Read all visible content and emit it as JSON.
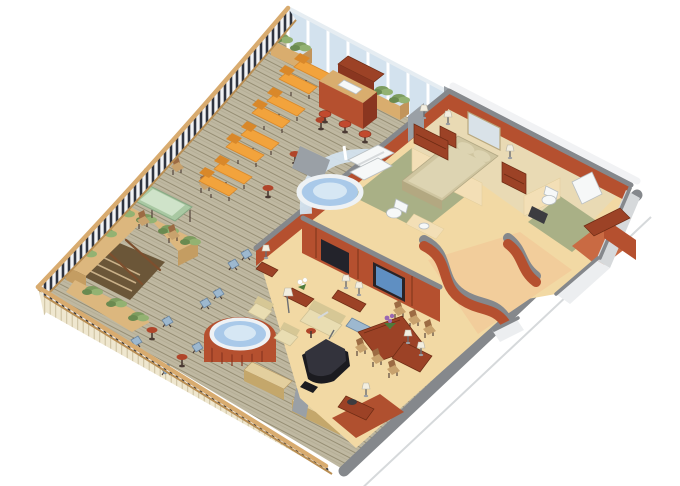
{
  "meta": {
    "scene": "Isometric cut-away floor plan illustration of a luxury ship penthouse suite with a large wrap-around teak veranda",
    "style": "3D isometric architectural rendering, white background, no text labels",
    "background": "#ffffff"
  },
  "areas": {
    "veranda_deck": {
      "label": "wrap-around teak deck",
      "features": [
        {
          "name": "curved-railing",
          "description": "wood top rail with dark balusters along the curved forward edge"
        },
        {
          "name": "glass-windbreak",
          "panels": 8
        },
        {
          "name": "sun-loungers",
          "count": 8,
          "arrangement": "4 pairs",
          "color": "orange"
        },
        {
          "name": "lounger-drink-tables",
          "count": 4,
          "color": "red"
        },
        {
          "name": "outdoor-bar",
          "stools": 4
        },
        {
          "name": "planter-boxes",
          "count": 2
        },
        {
          "name": "outdoor-dining-table",
          "top": "green glass",
          "chairs": 5
        },
        {
          "name": "pergola-stairwell",
          "description": "ivy-topped trellis enclosure around a private stair"
        },
        {
          "name": "bistro-sets",
          "tables": 2,
          "folding_chairs": 8
        },
        {
          "name": "deck-whirlpool",
          "shell": "terracotta",
          "water": "blue"
        },
        {
          "name": "deck-benches",
          "count": 2
        }
      ]
    },
    "suite_interior": {
      "master_bedroom": [
        "king-bed",
        "pillows",
        "mirror-panel",
        "nightstand-with-lamp x2",
        "dresser-with-lamp",
        "chest-with-lamp"
      ],
      "master_bathroom": [
        "shower-stall",
        "toilet",
        "vanity-with-sink",
        "green-tile-floor"
      ],
      "whirlpool_alcove": [
        "glass-bay",
        "whirlpool-tub",
        "stone-wall"
      ],
      "guest_bathroom": [
        "toilet",
        "dark-counter-sink",
        "shower",
        "green-tile-floor"
      ],
      "walk_in_closet": [
        "shelf-counter"
      ],
      "entry_foyer": [
        "curved-terracotta-walls",
        "entry-door"
      ],
      "living_room": [
        "media-cabinet-with-tv",
        "wall-tv-blue-screen",
        "sofa",
        "console-with-lamps x2",
        "armchairs x2",
        "coffee-table-with-white-flowers",
        "side-table-with-lamp",
        "floor-lamp",
        "round-side-table",
        "blue-bench"
      ],
      "dining_area": [
        "dark-wood-dining-table",
        "dining-chairs x6",
        "purple-orchid-centerpiece",
        "sideboard-with-lamps",
        "corner-sideboard-with-bowl"
      ],
      "music_corner": [
        "black-grand-piano",
        "piano-bench"
      ]
    }
  },
  "colors": {
    "bg": "#ffffff",
    "deck": "#bfb8a1",
    "deckLine": "#968e74",
    "deckLine2": "#a8a088",
    "fascia": "#efe7cf",
    "fasciaLine": "#cbbf9e",
    "fasciaTrim": "#b98e53",
    "cutGray": "#85888c",
    "extWhite": "#f1f2f4",
    "extShade": "#d6d9db",
    "white": "#ffffff",
    "railWood": "#d8ab6f",
    "railWoodDark": "#b98e53",
    "baluster": "#2f3440",
    "balusterBg": "#f2f3f5",
    "glass": "#d3e2ee",
    "glassFrame": "#ffffff",
    "planterBox": "#d9ad6e",
    "planterBoxSide": "#c2945a",
    "ivy1": "#7d9c5f",
    "ivy2": "#93b272",
    "ivy3": "#6a8a50",
    "lounger": "#f2a33c",
    "loungerDark": "#d9882a",
    "tableRed": "#b0452a",
    "stoolRed": "#c14a2e",
    "stoolDark": "#4a3a33",
    "chairWood": "#9c6b43",
    "chairWoodLight": "#c8a26d",
    "tableGreen": "#a9c8a2",
    "tableGreenLight": "#cfe3c9",
    "pergolaWall": "#dcb77e",
    "pergolaWallShade": "#c49d62",
    "pergolaInner": "#6b5638",
    "stairBrown": "#7d4f2e",
    "stepTan": "#c9b089",
    "tubWater": "#a9c9e9",
    "tubWaterLight": "#d6e7f4",
    "tubRim": "#eef2f5",
    "tubShell": "#b5502f",
    "tubShellDark": "#8a3620",
    "carpetLiving": "#f2d9a4",
    "carpetBed": "#e9dab4",
    "carpetEntry": "#f2cd9b",
    "bathFloor": "#a9b086",
    "floorRed": "#b0502f",
    "wallTerra": "#b5502f",
    "wallTerraLight": "#c96a43",
    "wallCream": "#f3dfb6",
    "wallWhite": "#eceef0",
    "furnRed": "#9c4226",
    "furnRedDark": "#6e2c14",
    "cream": "#e9ddb2",
    "creamShade": "#d6c795",
    "bedding": "#cfc5a0",
    "beddingLight": "#ddd4b2",
    "beddingSide": "#b3a881",
    "piano": "#1b1b20",
    "pianoTop": "#33333c",
    "tvBlue": "#5f8fc2",
    "tvDark": "#23232b",
    "lampShade": "#f2eee0",
    "lampStem": "#6b6e73",
    "metal": "#9aa0a6",
    "mirror": "#d9e2e8",
    "sinkWhite": "#f6f8f8",
    "fixtureStroke": "#b9bfc2",
    "benchTan": "#e3cf9e",
    "benchTanSide": "#c4a76b",
    "blueChair": "#9db8cf",
    "blueChairEdge": "#6b86a0",
    "flowerPurple": "#9a68b2",
    "leafGreen": "#4e7a3a"
  }
}
